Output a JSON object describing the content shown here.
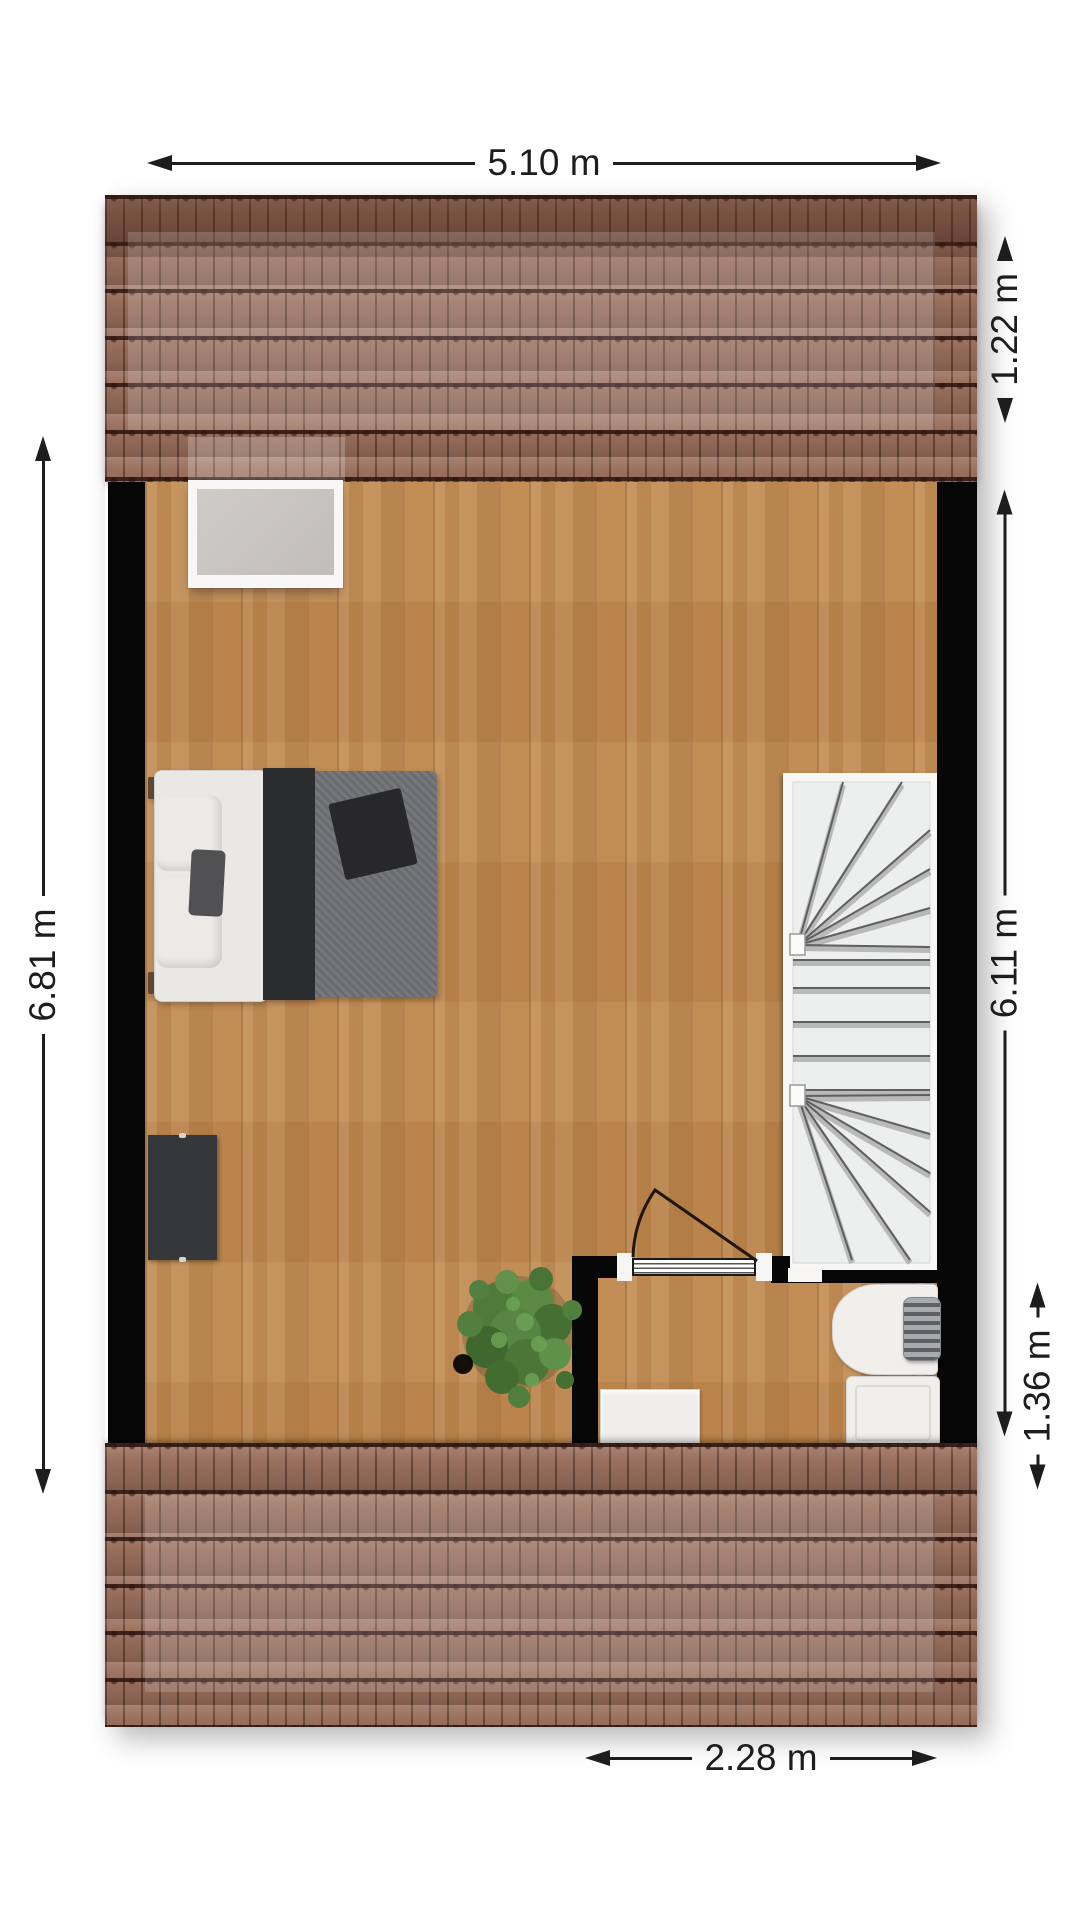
{
  "plan": {
    "dimensions": {
      "top": "5.10 m",
      "left": "6.81 m",
      "right_upper": "1.22 m",
      "right_middle": "6.11 m",
      "right_lower": "1.36 m",
      "bottom": "2.28 m"
    },
    "features": [
      "pitched-roof-top",
      "pitched-roof-bottom",
      "attic-room",
      "skylight-window",
      "double-bed",
      "tv-cabinet",
      "potted-plant",
      "winder-staircase",
      "inward-swinging-door",
      "bathroom",
      "washbasin",
      "towel-radiator",
      "shower-tray",
      "storage-unit"
    ],
    "colors": {
      "roof_tile": "#9a6f5d",
      "roof_ridge_shade": "rgba(62,28,20,0.38)",
      "floor_wood": "#c0894f",
      "wall": "#070707",
      "stair_tread": "#edeeee",
      "dimension_text": "#1d1d1d",
      "furniture_white": "#f0efec",
      "duvet_gray": "#6f7174",
      "blanket_dark": "#2b2c2e",
      "plant_green": "#4e7a3a"
    }
  }
}
